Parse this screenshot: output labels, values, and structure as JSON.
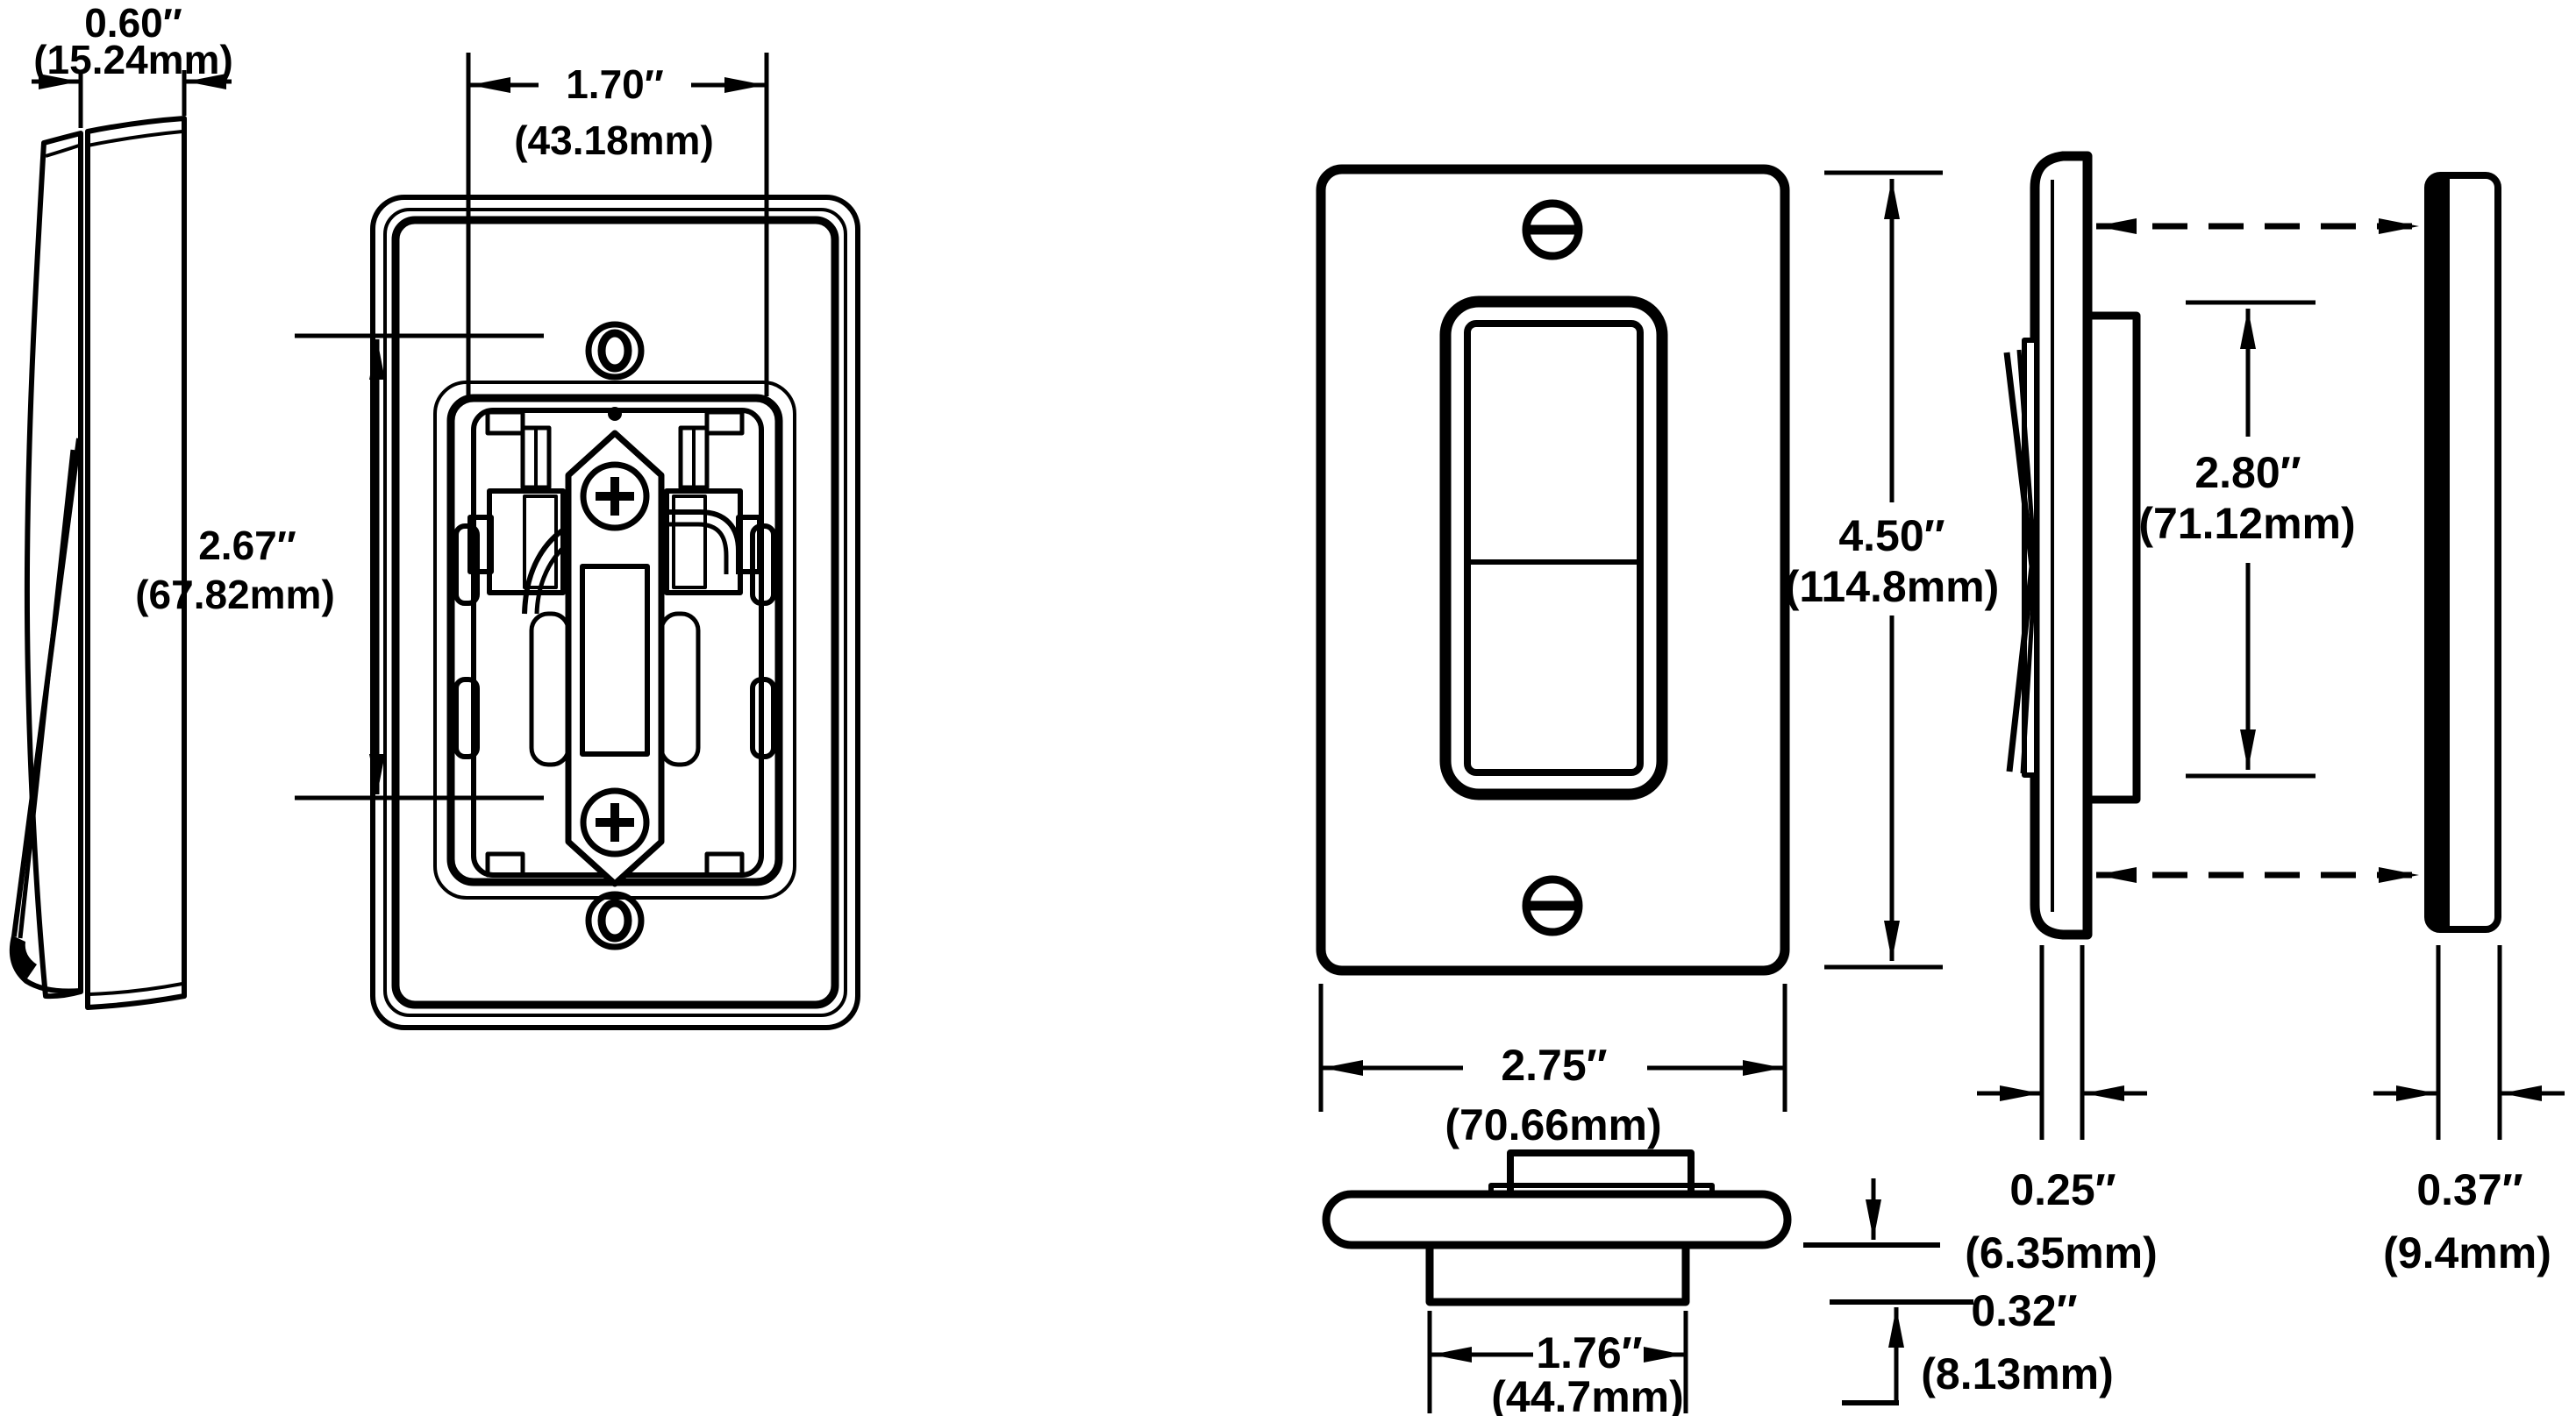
{
  "title": "Rocker switch with wallplate dimensional drawing",
  "colors": {
    "ink": "#000000",
    "background": "#ffffff"
  },
  "dims": {
    "side_assembled_depth": {
      "in": "0.60″",
      "mm": "(15.24mm)"
    },
    "rear_body_height": {
      "in": "2.67″",
      "mm": "(67.82mm)"
    },
    "rear_body_width": {
      "in": "1.70″",
      "mm": "(43.18mm)"
    },
    "front_plate_height": {
      "in": "4.50″",
      "mm": "(114.8mm)"
    },
    "front_plate_width": {
      "in": "2.75″",
      "mm": "(70.66mm)"
    },
    "side_opening_height": {
      "in": "2.80″",
      "mm": "(71.12mm)"
    },
    "plate_thickness": {
      "in": "0.25″",
      "mm": "(6.35mm)"
    },
    "box_thickness": {
      "in": "0.37″",
      "mm": "(9.4mm)"
    },
    "topview_body_width": {
      "in": "1.76″",
      "mm": "(44.7mm)"
    },
    "topview_depth": {
      "in": "0.32″",
      "mm": "(8.13mm)"
    }
  }
}
